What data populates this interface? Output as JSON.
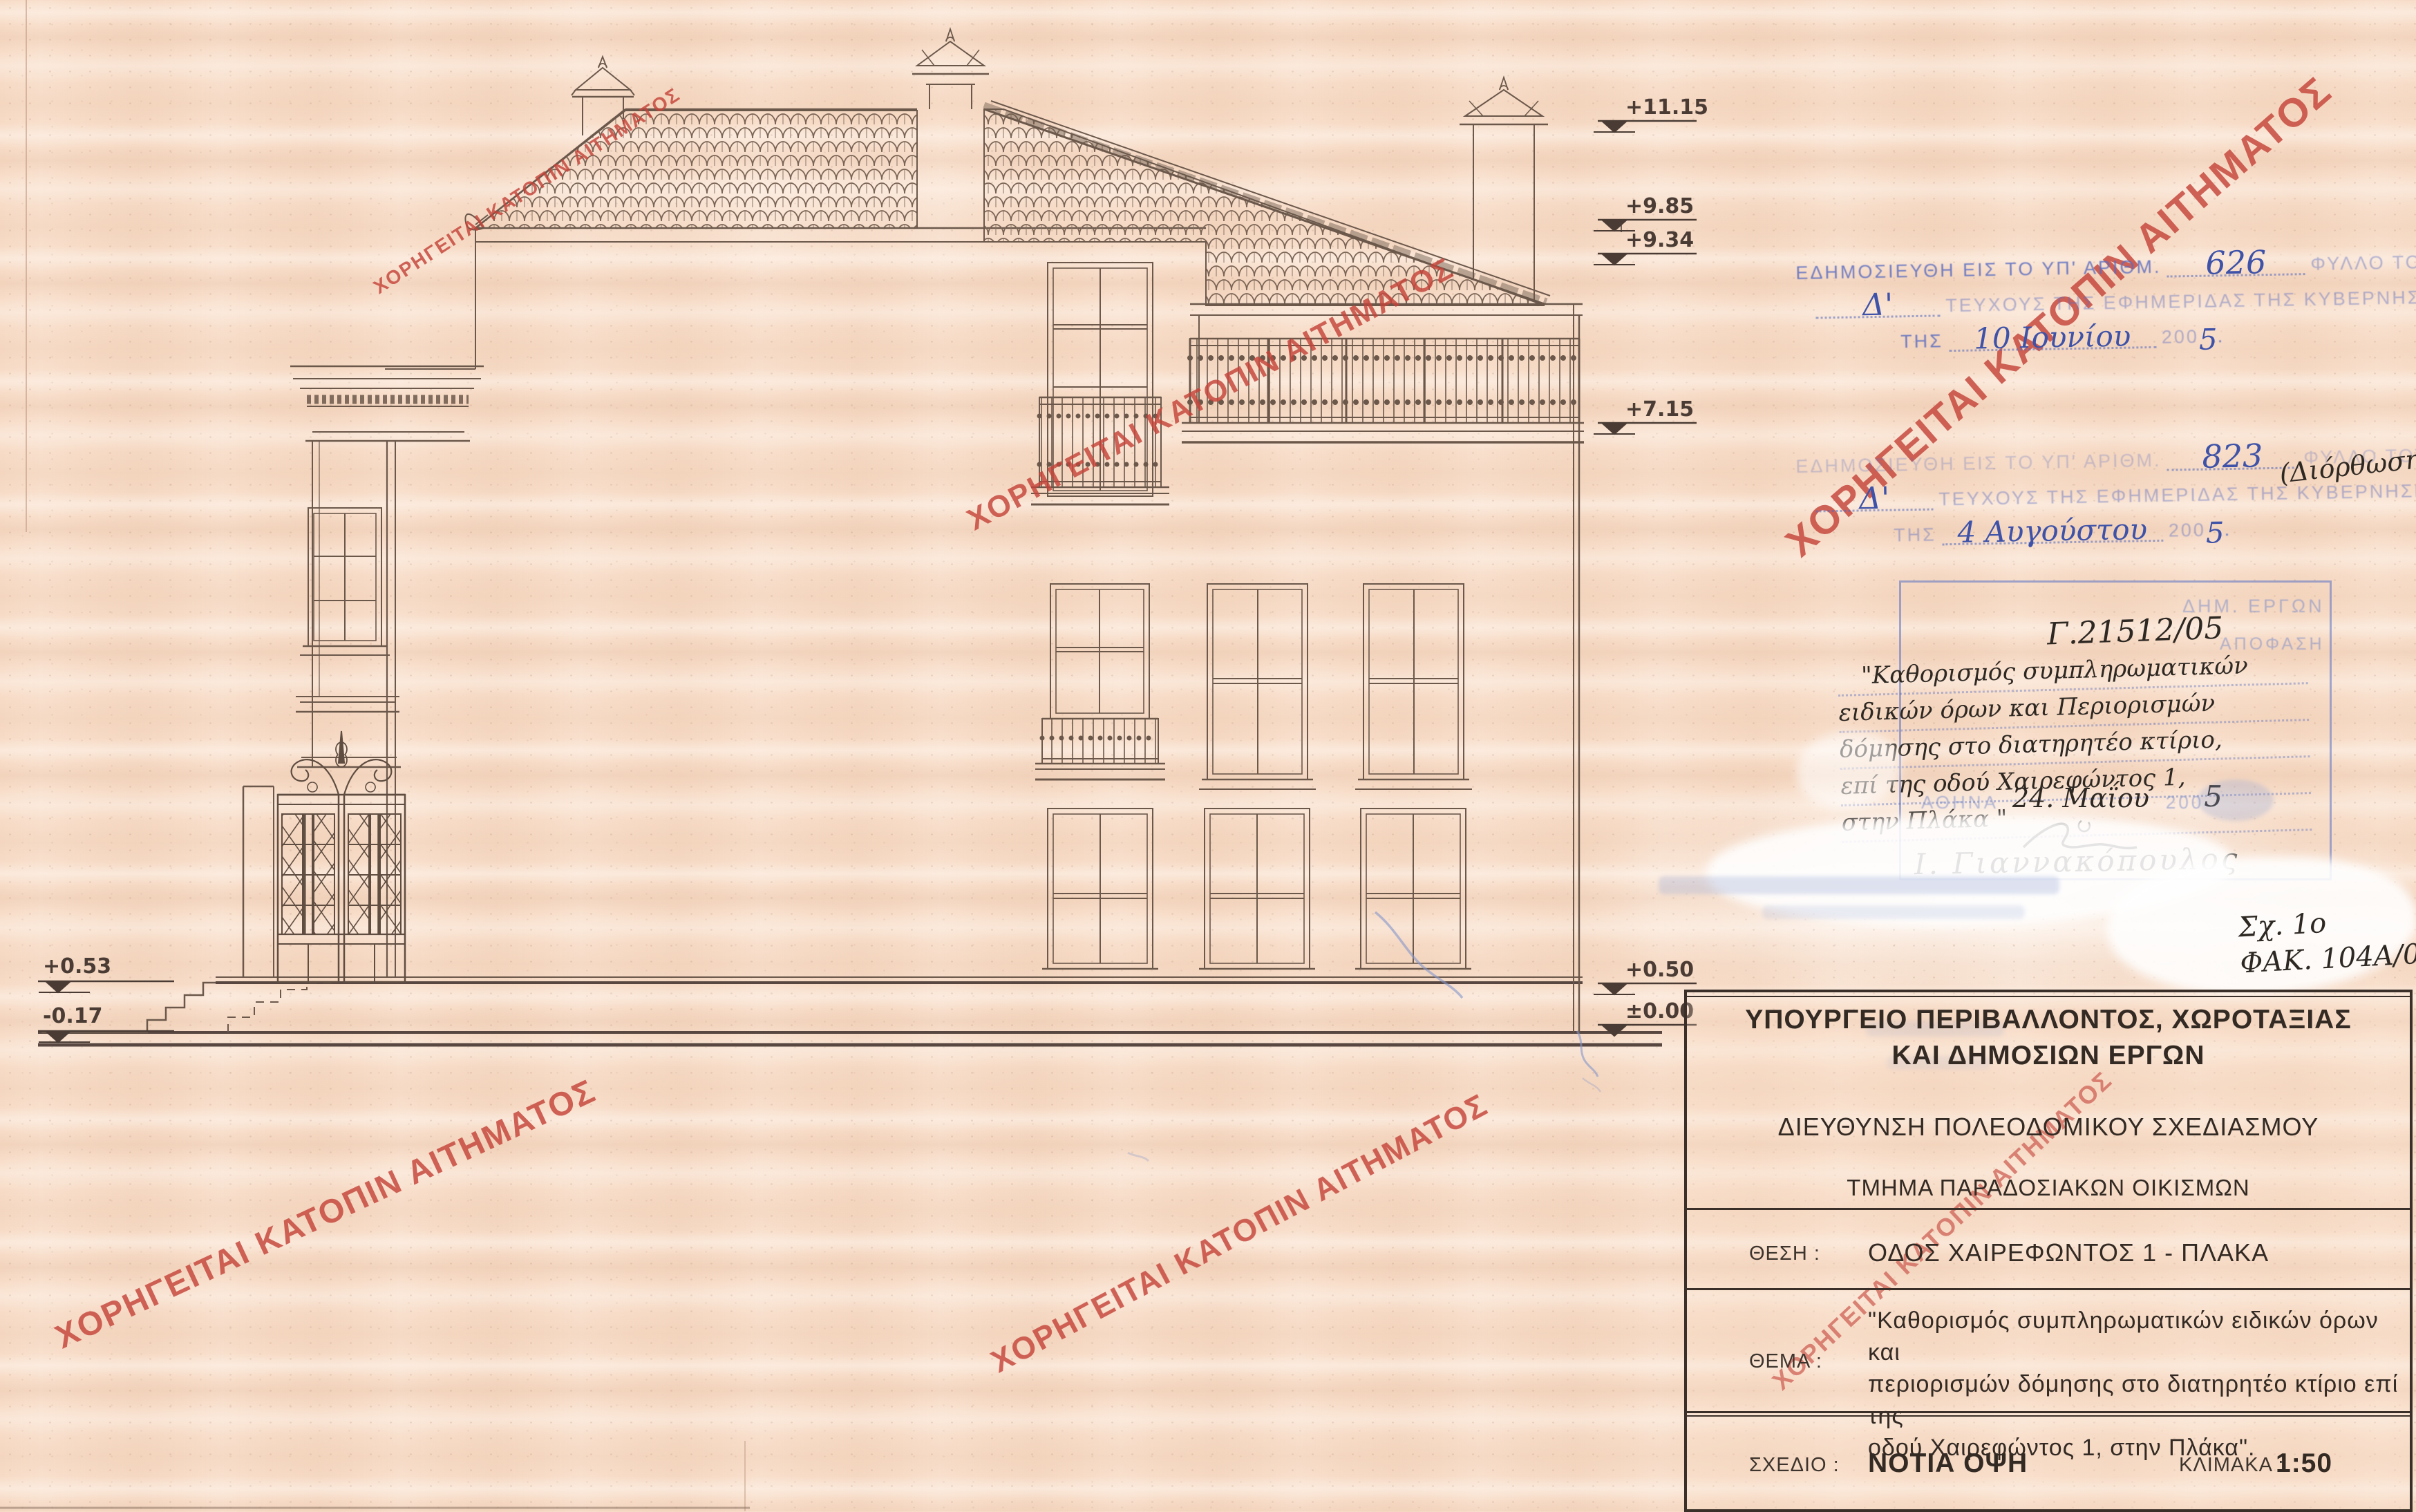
{
  "watermark": {
    "text": "ΧΟΡΗΓΕΙΤΑΙ ΚΑΤΟΠΙΝ ΑΙΤΗΜΑΤΟΣ",
    "color": "#c5443a"
  },
  "elevation_markers": {
    "right": [
      {
        "label": "+11.15"
      },
      {
        "label": "+9.85"
      },
      {
        "label": "+9.34"
      },
      {
        "label": "+7.15"
      },
      {
        "label": "+0.50"
      },
      {
        "label": "±0.00"
      }
    ],
    "left": [
      {
        "label": "+0.53"
      },
      {
        "label": "-0.17"
      }
    ]
  },
  "stamps": {
    "publication1": {
      "line1_prefix": "ΕΔΗΜΟΣΙΕΥΘΗ ΕΙΣ ΤΟ ΥΠ' ΑΡΙΘΜ.",
      "number": "626",
      "line1_suffix": "ΦΥΛΛΟ ΤΟΥ",
      "issue": "Δ'",
      "line2": "ΤΕΥΧΟΥΣ ΤΗΣ ΕΦΗΜΕΡΙΔΑΣ ΤΗΣ ΚΥΒΕΡΝΗΣΕΩΣ",
      "tis": "ΤΗΣ",
      "date": "10 Ιουνίου",
      "year_stamp": "200",
      "year_hand": "5",
      "period": "."
    },
    "publication2": {
      "line1_prefix": "ΕΔΗΜΟΣΙΕΥΘΗ ΕΙΣ ΤΟ ΥΠ' ΑΡΙΘΜ.",
      "number": "823",
      "line1_suffix": "ΦΥΛΛΟ ΤΟΥ",
      "issue": "Δ'",
      "line2": "ΤΕΥΧΟΥΣ ΤΗΣ ΕΦΗΜΕΡΙΔΑΣ ΤΗΣ ΚΥΒΕΡΝΗΣΕΩΣ",
      "tis": "ΤΗΣ",
      "date": "4 Αυγούστου",
      "year_stamp": "200",
      "year_hand": "5",
      "period": ".",
      "note": "(Διόρθωση)"
    },
    "decision_box": {
      "faded_header": "ΔΗΜ. ΕΡΓΩΝ",
      "faded_label": "ΑΠΟΦΑΣΗ",
      "protocol": "Γ.21512/05",
      "lines": [
        "\"Καθορισμός συμπληρωματικών",
        "ειδικών όρων και Περιορισμών",
        "δόμησης στο διατηρητέο κτίριο,",
        "επί της οδού Χαιρεφώντος 1,",
        "στην Πλάκα \""
      ],
      "city_stamp": "ΑΘΗΝΑ",
      "date_hand": "24. Μαΐου",
      "year_stamp": "200",
      "year_hand": "5",
      "signature_name": "Ι. Γιαννακόπουλος"
    },
    "file_note": {
      "line1": "Σχ. 1ο",
      "line2": "ΦΑΚ. 104Α/05"
    }
  },
  "title_block": {
    "ministry_line1": "ΥΠΟΥΡΓΕΙΟ ΠΕΡΙΒΑΛΛΟΝΤΟΣ, ΧΩΡΟΤΑΞΙΑΣ",
    "ministry_line2": "ΚΑΙ ΔΗΜΟΣΙΩΝ ΕΡΓΩΝ",
    "directorate": "ΔΙΕΥΘΥΝΣΗ ΠΟΛΕΟΔΟΜΙΚΟΥ ΣΧΕΔΙΑΣΜΟΥ",
    "department": "ΤΜΗΜΑ ΠΑΡΑΔΟΣΙΑΚΩΝ ΟΙΚΙΣΜΩΝ",
    "location_label": "ΘΕΣΗ :",
    "location_value": "ΟΔΟΣ ΧΑΙΡΕΦΩΝΤΟΣ 1 - ΠΛΑΚΑ",
    "subject_label": "ΘΕΜΑ :",
    "subject_lines": [
      "\"Καθορισμός συμπληρωματικών ειδικών όρων και",
      "περιορισμών δόμησης στο διατηρητέο κτίριο επί της",
      "οδού Χαιρεφώντος 1, στην Πλάκα\"."
    ],
    "drawing_label": "ΣΧΕΔΙΟ :",
    "drawing_value": "ΝΟΤΙΑ ΟΨΗ",
    "scale_label": "ΚΛΙΜΑΚΑ :",
    "scale_value": "1:50"
  }
}
